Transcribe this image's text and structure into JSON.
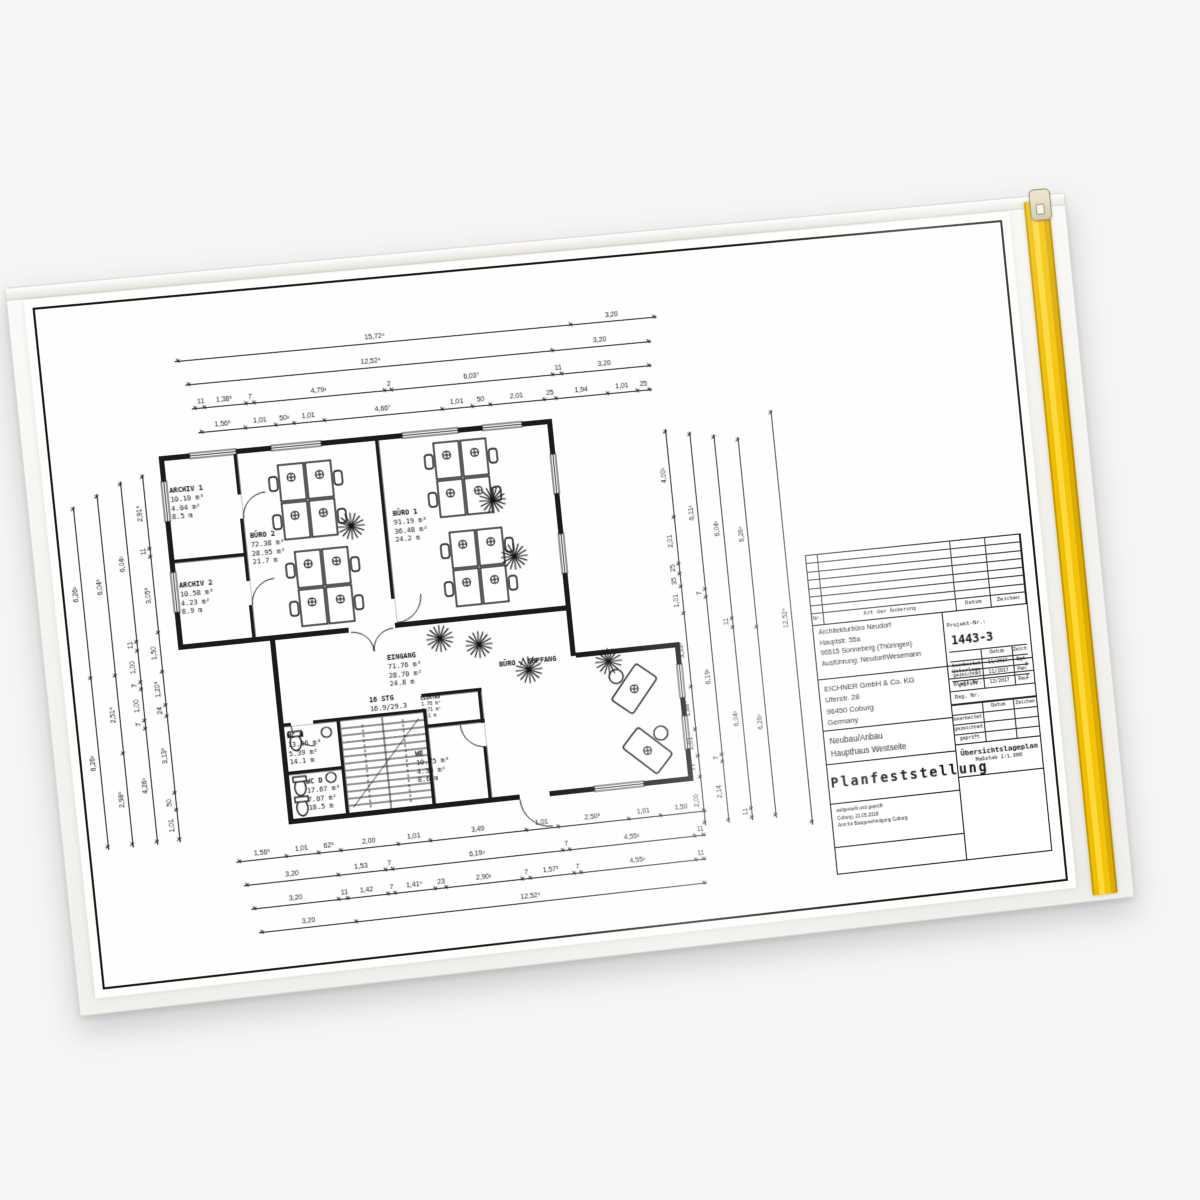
{
  "photo": {
    "background": "#f5f5f6",
    "sleeve_color": "#f3f1ec",
    "zip_color": "#f3c40e",
    "paper_color": "#fefefd",
    "ink_color": "#161616"
  },
  "icons": {
    "plant": "starburst-plant",
    "desk_mark": "circle-plus",
    "zip_pull": "zipper-slider"
  },
  "plan": {
    "rooms": {
      "archiv1": {
        "name": "ARCHIV 1",
        "v": "10.10 m³",
        "a": "4.04 m²",
        "len": "8.5 m"
      },
      "archiv2": {
        "name": "ARCHIV 2",
        "v": "10.58 m³",
        "a": "4.23 m²",
        "len": "8.9 m"
      },
      "buero2": {
        "name": "BÜRO 2",
        "v": "72.38 m³",
        "a": "28.95 m²",
        "len": "21.7 m"
      },
      "buero1": {
        "name": "BÜRO 1",
        "v": "91.19 m³",
        "a": "36.48 m²",
        "len": "24.2 m"
      },
      "eingang": {
        "name": "EINGANG",
        "v": "71.76 m³",
        "a": "28.70 m²",
        "len": "24.8 m"
      },
      "wch": {
        "name": "WC H",
        "v": "13.46 m³",
        "a": "5.39 m²",
        "len": "14.1 m"
      },
      "wcd": {
        "name": "WC D",
        "v": "17.67 m³",
        "a": "7.07 m²",
        "len": "18.5 m"
      },
      "we": {
        "name": "WE",
        "v": "10.75 m³",
        "a": "4.30 m²",
        "len": "8.6 m"
      },
      "elektro": {
        "name": "ELEKTRO",
        "v": "1.78 m³",
        "a": "0.71 m²",
        "len": "1.1 m"
      },
      "empfang": {
        "name": "BÜRO / EMPFANG",
        "v": "",
        "a": "",
        "len": ""
      }
    },
    "stairs": {
      "l1": "16 STG",
      "l2": "16.9/29.3"
    }
  },
  "dims": {
    "top": [
      [
        "15,72⁴",
        "3,20"
      ],
      [
        "12,52⁴",
        "3,20"
      ],
      [
        "11",
        "1,38⁵",
        "7",
        "4,79³",
        "2",
        "6,03⁷",
        "11",
        "3,20"
      ],
      [
        "1,56⁵",
        "1,01",
        "50²",
        "1,01",
        "4,66⁷",
        "1,01",
        "50",
        "2,01",
        "25",
        "1,94",
        "1,01",
        "25"
      ]
    ],
    "bottom": [
      [
        "1,56⁵",
        "1,01",
        "62⁵",
        "2,00",
        "1,01",
        "3,49",
        "1,01",
        "2,50⁵",
        "1,01",
        "1,50"
      ],
      [
        "3,20",
        "1,53",
        "7",
        "6,19³",
        "7",
        "4,55³",
        "11"
      ],
      [
        "3,20",
        "11",
        "1,42",
        "7",
        "1,41⁶",
        "23",
        "2,90¹",
        "7",
        "1,57⁵",
        "7",
        "4,55²",
        "11"
      ],
      [
        "3,20",
        "12,52⁴"
      ]
    ],
    "left": [
      [
        "6,26²",
        "6,26²"
      ],
      [
        "2,98⁶",
        "2,51⁶",
        "6,04⁶"
      ],
      [
        "4,26³",
        "7",
        "1,00",
        "7",
        "1,00",
        "11",
        "6,04²"
      ],
      [
        "1,01",
        "50",
        "3,13⁶",
        "24",
        "1,20⁸",
        "1,50",
        "3,05⁸",
        "11",
        "2,91⁸"
      ]
    ],
    "right": [
      [
        "2,00",
        "77",
        "1,01",
        "1,88⁶",
        "3,39³",
        "1,01",
        "35",
        "25",
        "2,01",
        "4,00²"
      ],
      [
        "2,14",
        "7",
        "6,19³",
        "7",
        "6,11³"
      ],
      [
        "11",
        "6,04³",
        "11",
        "6,04³"
      ],
      [
        "6,26³",
        "6,26³"
      ],
      [
        "12,52⁴"
      ]
    ]
  },
  "titleblock": {
    "revision": {
      "nr": "Nr.",
      "change": "Art der Änderung",
      "datum": "Datum",
      "zeichen": "Zeichen"
    },
    "architect": [
      "Architekturbüro Neudorf",
      "Hauptstr. 55a",
      "96515 Sonneberg (Thüringen)",
      "Ausführung: Neudorf/Wesemann"
    ],
    "projekt_label": "Projekt-Nr.:",
    "projekt_nr": "1443-3",
    "approvals": {
      "datum": "Datum",
      "zeichen": "Zeichen",
      "rows": [
        {
          "label": "bearbeitet",
          "datum": "11/2017",
          "zeichen": "Bgt"
        },
        {
          "label": "gezeichnet",
          "datum": "11/2017",
          "zeichen": "Peh"
        },
        {
          "label": "geprüft",
          "datum": "12/2017",
          "zeichen": "Reu"
        }
      ]
    },
    "client": [
      "EICHNER GmbH & Co. KG",
      "Uferstr. 28",
      "96450 Coburg",
      "Germany"
    ],
    "doc_info": {
      "unterlage_label": "Unterlage",
      "unterlage": "3",
      "blatt_label": "Blatt Nr.",
      "blatt": "1",
      "reg_label": "Reg. Nr.",
      "reg": "",
      "datum": "Datum",
      "zeichen": "Zeichen",
      "rows": [
        "bearbeitet",
        "gezeichnet",
        "geprüft"
      ]
    },
    "project": [
      "Neubau/Anbau",
      "Haupthaus Westseite"
    ],
    "title": "Planfeststellung",
    "plan_type": "Übersichtslageplan",
    "massstab": "Maßstab  1:1.000",
    "note": [
      "aufgestellt und geprüft",
      "Coburg, 21.05.2018",
      "Amt für Baugenehmigung Coburg"
    ]
  }
}
